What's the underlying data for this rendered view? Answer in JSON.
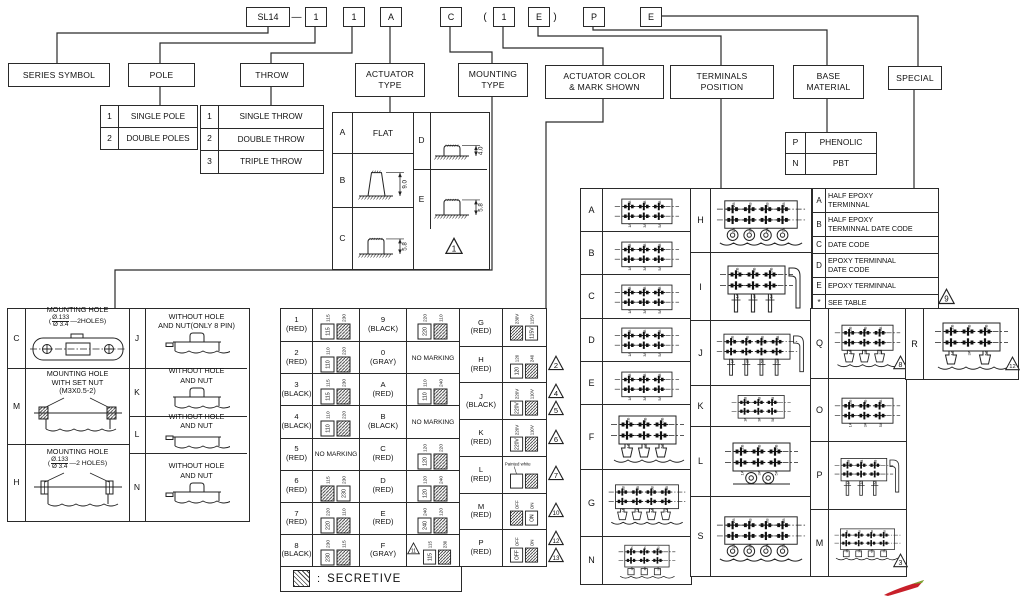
{
  "colors": {
    "line": "#2a2a2a",
    "red_logo": "#c8202a"
  },
  "part_number": {
    "series": "SL14",
    "dash": "—",
    "open_paren": "(",
    "close_paren": ")",
    "codes": [
      "1",
      "1",
      "A",
      "C",
      "1",
      "E",
      "P",
      "E"
    ]
  },
  "categories": {
    "series": {
      "lines": [
        "SERIES SYMBOL"
      ]
    },
    "pole": {
      "lines": [
        "POLE"
      ]
    },
    "throw": {
      "lines": [
        "THROW"
      ]
    },
    "actuator": {
      "lines": [
        "ACTUATOR",
        "TYPE"
      ]
    },
    "mounting": {
      "lines": [
        "MOUNTING",
        "TYPE"
      ]
    },
    "color": {
      "lines": [
        "ACTUATOR COLOR",
        "& MARK SHOWN"
      ]
    },
    "terminals": {
      "lines": [
        "TERMINALS",
        "POSITION"
      ]
    },
    "base": {
      "lines": [
        "BASE",
        "MATERIAL"
      ]
    },
    "special": {
      "lines": [
        "SPECIAL"
      ]
    }
  },
  "pole_table": [
    {
      "code": "1",
      "label": "SINGLE POLE"
    },
    {
      "code": "2",
      "label": "DOUBLE POLES"
    }
  ],
  "throw_table": [
    {
      "code": "1",
      "label": "SINGLE THROW"
    },
    {
      "code": "2",
      "label": "DOUBLE THROW"
    },
    {
      "code": "3",
      "label": "TRIPLE THROW"
    }
  ],
  "actuator_table": {
    "left": [
      {
        "code": "A",
        "label": "FLAT"
      },
      {
        "code": "B",
        "dim": "9.0",
        "shape": "tall"
      },
      {
        "code": "C",
        "dim": "5.8",
        "shape": "low"
      }
    ],
    "right": [
      {
        "code": "D",
        "dim": "4.0",
        "shape": "low"
      },
      {
        "code": "E",
        "dim": "5.8",
        "shape": "low"
      }
    ],
    "triangle": "1"
  },
  "base_table": [
    {
      "code": "P",
      "label": "PHENOLIC"
    },
    {
      "code": "N",
      "label": "PBT"
    }
  ],
  "special_table": {
    "rows": [
      {
        "code": "A",
        "lines": [
          "HALF EPOXY",
          "TERMINNAL"
        ]
      },
      {
        "code": "B",
        "lines": [
          "HALF EPOXY",
          "TERMINNAL DATE CODE"
        ]
      },
      {
        "code": "C",
        "lines": [
          "DATE CODE"
        ]
      },
      {
        "code": "D",
        "lines": [
          "EPOXY TERMINNAL",
          "DATE CODE"
        ]
      },
      {
        "code": "E",
        "lines": [
          "EPOXY TERMINNAL"
        ]
      },
      {
        "code": "*",
        "lines": [
          "SEE  TABLE"
        ]
      }
    ],
    "triangle": "9"
  },
  "mounting_table": {
    "left": [
      {
        "code": "C",
        "lines": [
          "MOUNTING HOLE"
        ],
        "frac_prefix": "(",
        "frac_top": "Ø.133",
        "frac_bottom": "Ø 3.4",
        "frac_suffix": "—2HOLES)",
        "drawing": "slot-plate"
      },
      {
        "code": "M",
        "lines": [
          "MOUNTING HOLE",
          "WITH SET NUT",
          "(M3X0.5-2)"
        ],
        "drawing": "set-nut"
      },
      {
        "code": "H",
        "lines": [
          "MOUNTING HOLE"
        ],
        "frac_prefix": "(",
        "frac_top": "Ø.133",
        "frac_bottom": "Ø 3.4",
        "frac_suffix": "—2 HOLES)",
        "drawing": "hole-panel"
      }
    ],
    "right": [
      {
        "code": "J",
        "lines": [
          "WITHOUT HOLE",
          "AND NUT(ONLY 8 PIN)"
        ],
        "drawing": "cap-pin"
      },
      {
        "code": "K",
        "lines": [
          "WITHOUT HOLE",
          "AND NUT"
        ],
        "drawing": "cap"
      },
      {
        "code": "L",
        "lines": [
          "WITHOUT HOLE",
          "AND NUT"
        ],
        "drawing": "flat-pin"
      },
      {
        "code": "N",
        "lines": [
          "WITHOUT HOLE",
          "AND NUT"
        ],
        "drawing": "cap-pin"
      }
    ]
  },
  "color_table": {
    "legend": "SECRETIVE",
    "legend_sep": ":",
    "no_marking_text": "NO MARKING",
    "columns": [
      [
        {
          "code": "1",
          "color": "(RED)",
          "left": "115",
          "right": "230",
          "hatch": "right"
        },
        {
          "code": "2",
          "color": "(RED)",
          "left": "110",
          "right": "220",
          "hatch": "right"
        },
        {
          "code": "3",
          "color": "(BLACK)",
          "left": "115",
          "right": "230",
          "hatch": "right"
        },
        {
          "code": "4",
          "color": "(BLACK)",
          "left": "110",
          "right": "220",
          "hatch": "right"
        },
        {
          "code": "5",
          "color": "(RED)",
          "no_marking": true
        },
        {
          "code": "6",
          "color": "(RED)",
          "left": "115",
          "right": "230",
          "hatch": "left"
        },
        {
          "code": "7",
          "color": "(RED)",
          "left": "220",
          "right": "110",
          "hatch": "right"
        },
        {
          "code": "8",
          "color": "(BLACK)",
          "left": "230",
          "right": "115",
          "hatch": "right"
        }
      ],
      [
        {
          "code": "9",
          "color": "(BLACK)",
          "left": "220",
          "right": "110",
          "hatch": "right"
        },
        {
          "code": "0",
          "color": "(GRAY)",
          "no_marking": true
        },
        {
          "code": "A",
          "color": "(RED)",
          "left": "110",
          "right": "240",
          "hatch": "right"
        },
        {
          "code": "B",
          "color": "(BLACK)",
          "no_marking": true
        },
        {
          "code": "C",
          "color": "(RED)",
          "left": "120",
          "right": "220",
          "hatch": "right"
        },
        {
          "code": "D",
          "color": "(RED)",
          "left": "120",
          "right": "240",
          "hatch": "right"
        },
        {
          "code": "E",
          "color": "(RED)",
          "left": "240",
          "right": "120",
          "hatch": "right"
        },
        {
          "code": "F",
          "color": "(GRAY)",
          "left": "115",
          "right": "230",
          "hatch": "right",
          "triangles": [
            "11"
          ]
        }
      ],
      [
        {
          "code": "G",
          "color": "(RED)",
          "left": "230V",
          "right": "115V",
          "hatch": "left"
        },
        {
          "code": "H",
          "color": "(RED)",
          "left": "120",
          "right": "240",
          "hatch": "right",
          "triangles": [
            "2"
          ]
        },
        {
          "code": "J",
          "color": "(BLACK)",
          "left": "220V",
          "right": "110V",
          "hatch": "right",
          "triangles": [
            "4",
            "5"
          ]
        },
        {
          "code": "K",
          "color": "(RED)",
          "left": "220V",
          "right": "110V",
          "hatch": "right",
          "triangles": [
            "6"
          ]
        },
        {
          "code": "L",
          "color": "(RED)",
          "note": "Painted white",
          "left": "",
          "right": "",
          "hatch": "right",
          "triangles": [
            "7"
          ]
        },
        {
          "code": "M",
          "color": "(RED)",
          "left": "OFF",
          "right": "ON",
          "hatch": "left",
          "triangles": [
            "10"
          ]
        },
        {
          "code": "P",
          "color": "(RED)",
          "left": "OFF",
          "right": "ON",
          "hatch": "right",
          "triangles": [
            "12",
            "13"
          ]
        }
      ]
    ]
  },
  "terminals_tables": {
    "pin_labels_top": [
      "2B",
      "4B",
      "6B",
      "8B"
    ],
    "pin_labels_bottom": [
      "1A",
      "3A",
      "5A",
      "7A"
    ],
    "groups": [
      {
        "rows": [
          {
            "code": "A",
            "pins": 6,
            "feet": "none"
          },
          {
            "code": "B",
            "pins": 6,
            "feet": "none"
          },
          {
            "code": "C",
            "pins": 6,
            "feet": "none"
          },
          {
            "code": "D",
            "pins": 6,
            "feet": "none"
          },
          {
            "code": "E",
            "pins": 6,
            "feet": "none"
          },
          {
            "code": "F",
            "pins": 6,
            "feet": "standoff"
          },
          {
            "code": "G",
            "pins": 8,
            "feet": "standoff"
          },
          {
            "code": "N",
            "pins": 6,
            "feet": "smt"
          }
        ]
      },
      {
        "rows": [
          {
            "code": "H",
            "pins": 8,
            "feet": "round"
          },
          {
            "code": "I",
            "pins": 6,
            "feet": "longpins",
            "bracket": true
          },
          {
            "code": "J",
            "pins": 8,
            "feet": "longpins",
            "bracket": true
          },
          {
            "code": "K",
            "pins": 6,
            "feet": "none"
          },
          {
            "code": "L",
            "pins": 6,
            "feet": "round2"
          },
          {
            "code": "S",
            "pins": 8,
            "feet": "round"
          }
        ]
      },
      {
        "rows": [
          {
            "code": "Q",
            "pins": 6,
            "feet": "standoff",
            "triangles": [
              "8"
            ]
          },
          {
            "code": "O",
            "pins": 6,
            "feet": "none"
          },
          {
            "code": "P",
            "pins": 6,
            "feet": "longpins",
            "bracket": true
          },
          {
            "code": "M",
            "pins": 8,
            "feet": "smt",
            "triangles": [
              "3"
            ]
          }
        ]
      },
      {
        "rows": [
          {
            "code": "R",
            "pins": 6,
            "feet": "standoff2",
            "triangles": [
              "12"
            ]
          }
        ]
      }
    ]
  }
}
